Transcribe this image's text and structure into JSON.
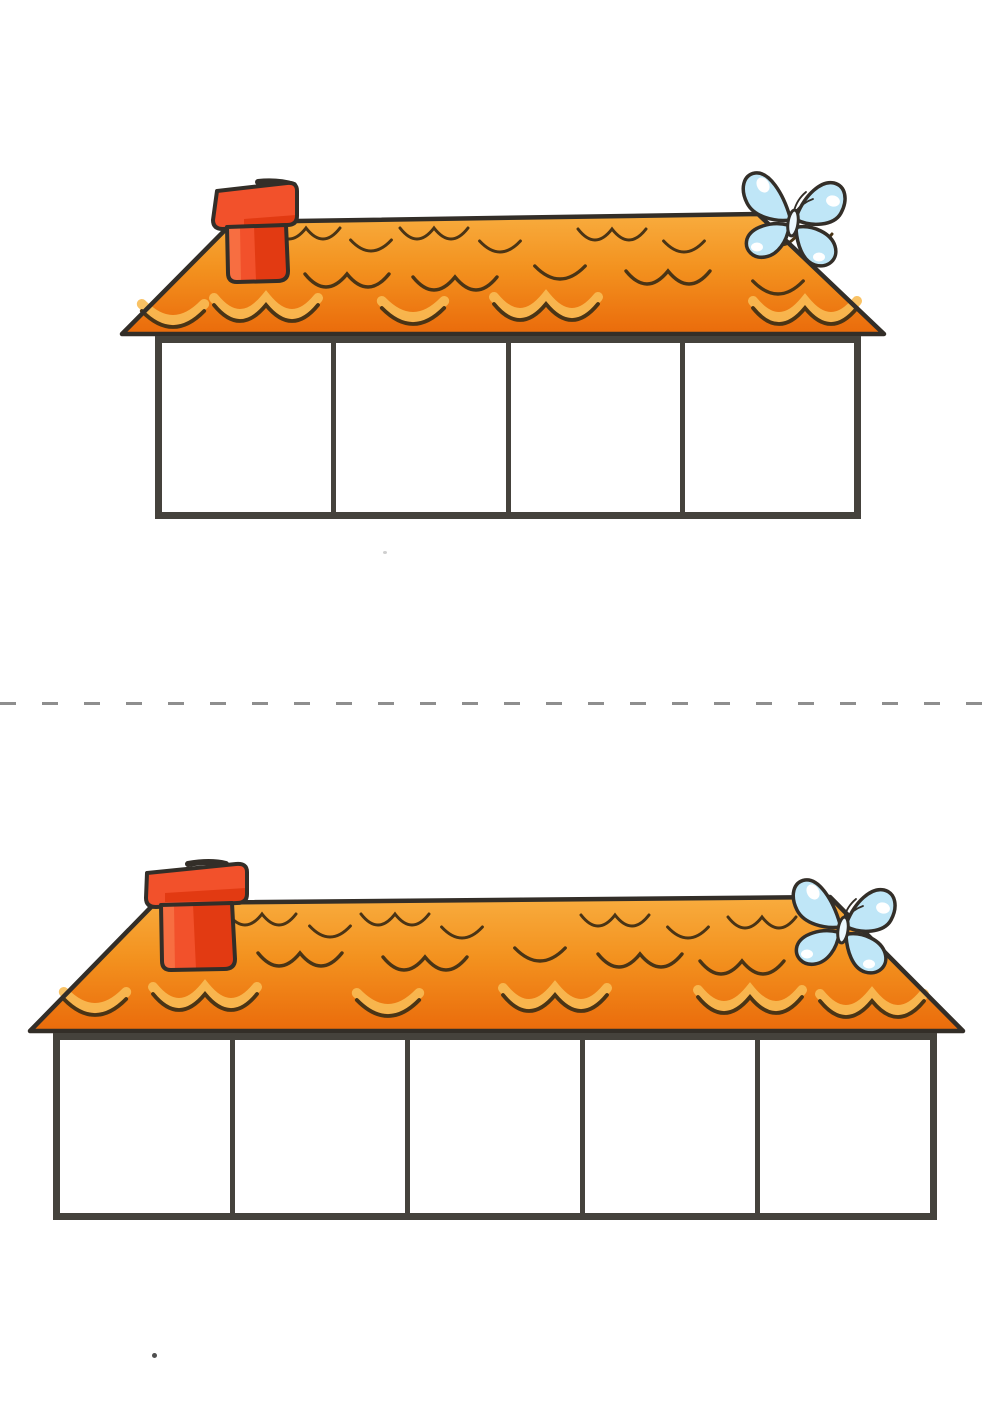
{
  "page": {
    "background_color": "#ffffff",
    "cut_line": {
      "style": "dashed",
      "color": "#8e8e8e"
    }
  },
  "palette": {
    "outline": "#332e28",
    "roof_gradient_top": "#f8ac3e",
    "roof_gradient_mid": "#f3921f",
    "roof_gradient_bottom": "#ea6b0b",
    "tile_stroke": "#4a3415",
    "tile_highlight": "#f8bb54",
    "chimney_red": "#f2512b",
    "chimney_red_dark": "#e23a12",
    "chimney_red_light": "#f97a4c",
    "butterfly_blue": "#bfe6f7",
    "butterfly_body": "#ecf7fd",
    "box_border": "#45423c",
    "box_fill": "#ffffff"
  },
  "houses": [
    {
      "name": "top-house",
      "empty_box_count": 4,
      "decorations": [
        "chimney",
        "butterfly"
      ]
    },
    {
      "name": "bottom-house",
      "empty_box_count": 5,
      "decorations": [
        "chimney",
        "butterfly"
      ]
    }
  ]
}
